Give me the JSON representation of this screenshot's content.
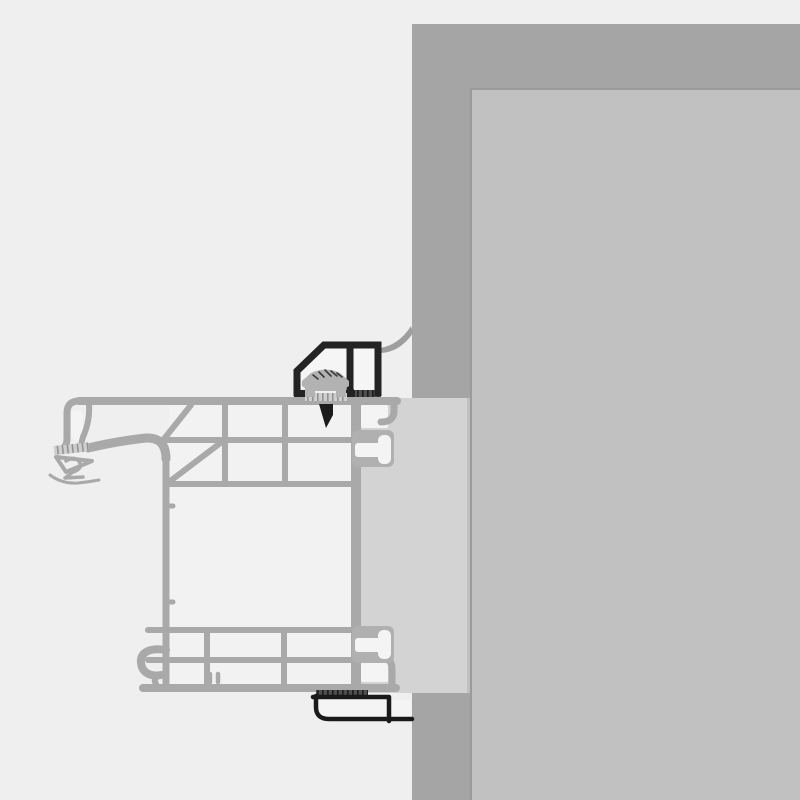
{
  "diagram": {
    "kind": "technical-section-drawing",
    "subject": "window frame installation cross-section at wall reveal"
  },
  "parts": {
    "wall": "wall",
    "reveal": "window-reveal",
    "extension_block": "frame-extension-block",
    "frame_profile": "window-frame-profile",
    "gasket_cluster": "outer-gasket",
    "anchor_lug_top": "anchor-lug-top",
    "anchor_lug_bottom": "anchor-lug-bottom",
    "bracket": "mounting-bracket",
    "screw": "fixing-screw",
    "sealing_tape_top": "compression-tape-top",
    "sealing_tape_bottom": "compression-tape-bottom",
    "shim": "bedding-shim",
    "membrane": "sealing-membrane",
    "trim": "drip-trim-profile"
  },
  "colors": {
    "background": "#efefef",
    "wall": "#a5a5a5",
    "reveal": "#c1c1c1",
    "reveal_edge": "#9b9b9b",
    "block": "#d3d3d3",
    "seam": "#c0c0c0",
    "profile": "#a9a9a9",
    "profile_fill": "#f2f2f2",
    "pocket": "#f4f4f4",
    "collar": "#b0b0b0",
    "membrane": "#9e9e9e",
    "bracket": "#232323",
    "bracket_int": "#f5f5f5",
    "head": "#b2b2b2",
    "head_hatch": "#3a3a3a",
    "shank": "#1c1c1c",
    "tape_base": "#4f4f4f",
    "tape_rib": "#1e1e1e",
    "shim_base": "#cfcfcf",
    "shim_rib": "#939393",
    "trim": "#1a1a1a",
    "trim_int": "#f4f4f4"
  }
}
